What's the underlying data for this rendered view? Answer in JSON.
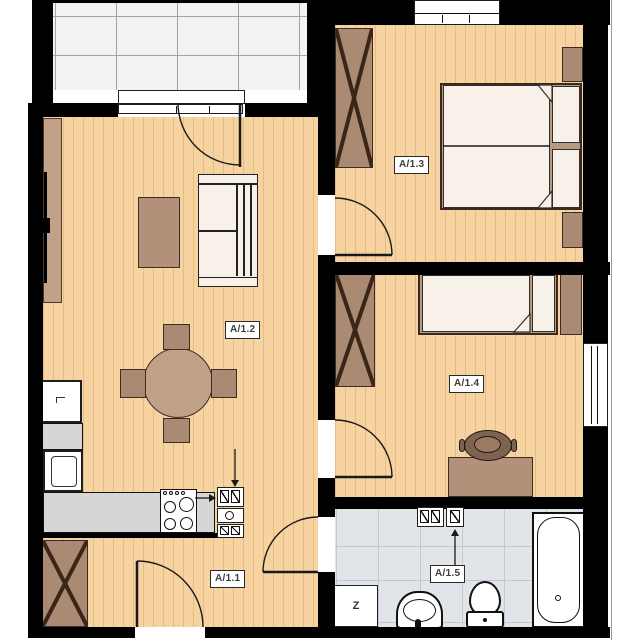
{
  "rooms": [
    {
      "label": "A/1.1"
    },
    {
      "label": "A/1.2"
    },
    {
      "label": "A/1.3"
    },
    {
      "label": "A/1.4"
    },
    {
      "label": "A/1.5"
    }
  ],
  "appliances": {
    "z_label": "Z"
  },
  "colors": {
    "wood": "#f6d3a0",
    "wood_line": "#e5bc85",
    "wall": "#000000",
    "balcony_tile": "#f3f3f1",
    "balcony_tile_line": "#a3a3a3",
    "bath_tile": "#e1e4e8",
    "bath_tile_line": "#c2c8ce",
    "counter": "#d6d6d6",
    "furniture_brown": "#ab8a74",
    "furniture_tan": "#c2a189",
    "bed_frame": "#b79a86",
    "textile_white": "#f8f1ea",
    "chair_dark": "#7d6350",
    "outline": "#1e1e1e"
  }
}
